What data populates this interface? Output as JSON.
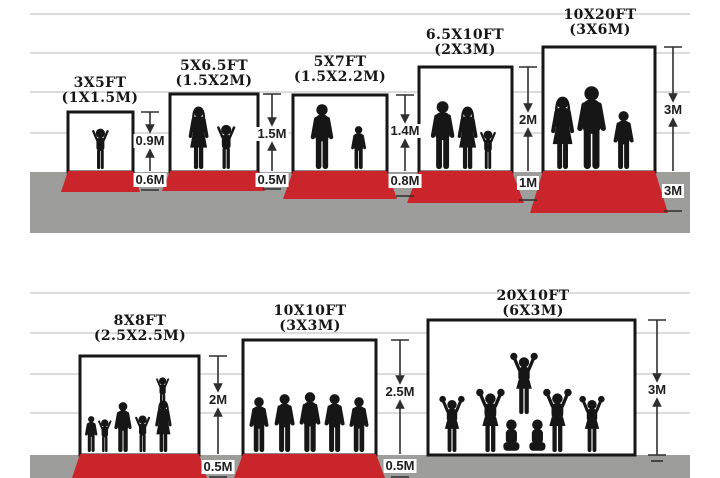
{
  "diagram": {
    "description": "Backdrop and floor carpet size comparison",
    "colors": {
      "carpet": "#c9252a",
      "floor": "#9d9d9b",
      "grid": "#c6c6c6",
      "ink": "#161616",
      "background": "#ffffff"
    },
    "top": {
      "panels": [
        {
          "size_ft": "3X5FT",
          "size_m": "(1X1.5M)",
          "backdrop_height": "0.9M",
          "floor_depth": "0.6M",
          "figures": "toddler"
        },
        {
          "size_ft": "5X6.5FT",
          "size_m": "(1.5X2M)",
          "backdrop_height": "1.5M",
          "floor_depth": "0.5M",
          "figures": "mother-and-child"
        },
        {
          "size_ft": "5X7FT",
          "size_m": "(1.5X2.2M)",
          "backdrop_height": "1.4M",
          "floor_depth": "0.8M",
          "figures": "father-and-son"
        },
        {
          "size_ft": "6.5X10FT",
          "size_m": "(2X3M)",
          "backdrop_height": "2M",
          "floor_depth": "1M",
          "figures": "family-of-three"
        },
        {
          "size_ft": "10X20FT",
          "size_m": "(3X6M)",
          "backdrop_height": "3M",
          "floor_depth": "3M",
          "figures": "family-of-three"
        }
      ]
    },
    "bottom": {
      "panels": [
        {
          "size_ft": "8X8FT",
          "size_m": "(2.5X2.5M)",
          "backdrop_height": "2M",
          "floor_depth": "0.5M",
          "figures": "family-group-with-child-on-shoulders"
        },
        {
          "size_ft": "10X10FT",
          "size_m": "(3X3M)",
          "backdrop_height": "2.5M",
          "floor_depth": "0.5M",
          "figures": "sports-team-of-five"
        },
        {
          "size_ft": "20X10FT",
          "size_m": "(6X3M)",
          "backdrop_height": "3M",
          "figures": "cheerleading-squad"
        }
      ]
    }
  }
}
